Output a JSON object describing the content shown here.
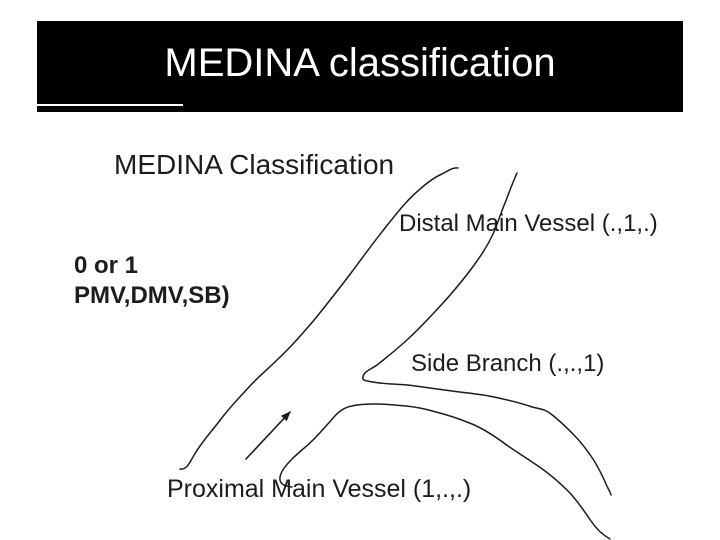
{
  "slide": {
    "title": "MEDINA classification"
  },
  "diagram": {
    "title": "MEDINA Classification",
    "note_line1": "0 or 1",
    "note_line2": "PMV,DMV,SB)",
    "labels": {
      "distal": "Distal Main Vessel (.,1,.)",
      "side": "Side Branch (.,.,1)",
      "proximal": "Proximal Main Vessel (1,.,.)"
    }
  },
  "colors": {
    "background": "#ffffff",
    "header_bg": "#000000",
    "header_text": "#ffffff",
    "underline": "#ffffff",
    "ink": "#1c1c1c"
  }
}
